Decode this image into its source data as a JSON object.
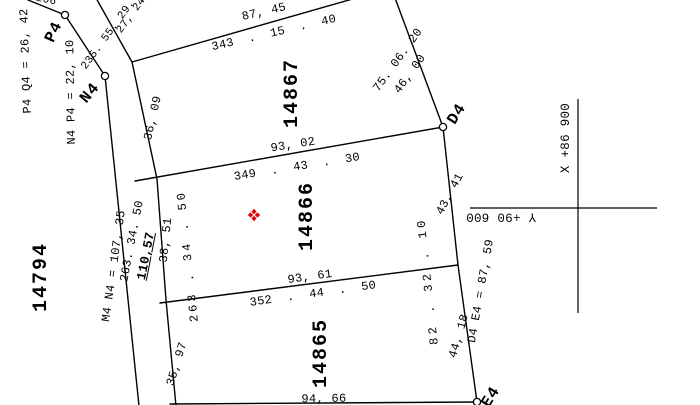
{
  "parcels": {
    "p14867": "14867",
    "p14866": "14866",
    "p14865": "14865",
    "p14794": "14794"
  },
  "points": {
    "p4": "P4",
    "n4": "N4",
    "d4": "D4",
    "e4": "E4"
  },
  "point_distances": {
    "p4_q4": "P4 Q4 = 26, 42",
    "n4_p4": "N4 P4 = 22, 10",
    "m4_n4": "M4 N4 = 107, 35",
    "d4_e4": "D4 E4 = 87, 59"
  },
  "edges": {
    "top": {
      "distance": "87, 45",
      "bearing": "343  .  15  .  40"
    },
    "upper_right": {
      "bearing": "75. 06. 20",
      "distance": "46, 00"
    },
    "middle": {
      "distance": "93, 02",
      "bearing": "349  .  43  .  30"
    },
    "lower": {
      "distance": "93, 61",
      "bearing": "352  .  44  .  50"
    },
    "bottom": {
      "distance": "94, 66"
    },
    "left_outer": {
      "bearing": "263. 34. 50",
      "highlighted_value": "110,57"
    },
    "left_inner_upper": {
      "distance": "36, 09"
    },
    "left_inner_middle": {
      "distance": "38, 51",
      "bearing": "263 . 34 . 50"
    },
    "left_inner_lower": {
      "distance": "35, 97"
    },
    "right_upper": {
      "distance": "43, 41"
    },
    "right_lower": {
      "distance": "44, 18",
      "bearing": "82 . 32 . 10"
    },
    "top_left": {
      "bearing": "235. 55. 29. 50",
      "distance": "27, 24",
      "clipped": "206"
    }
  },
  "grid": {
    "x_axis": "X +86 900",
    "y_axis": "Y +90 600"
  },
  "colors": {
    "background": "#ffffff",
    "line": "#000000",
    "marker": "#e10000"
  }
}
